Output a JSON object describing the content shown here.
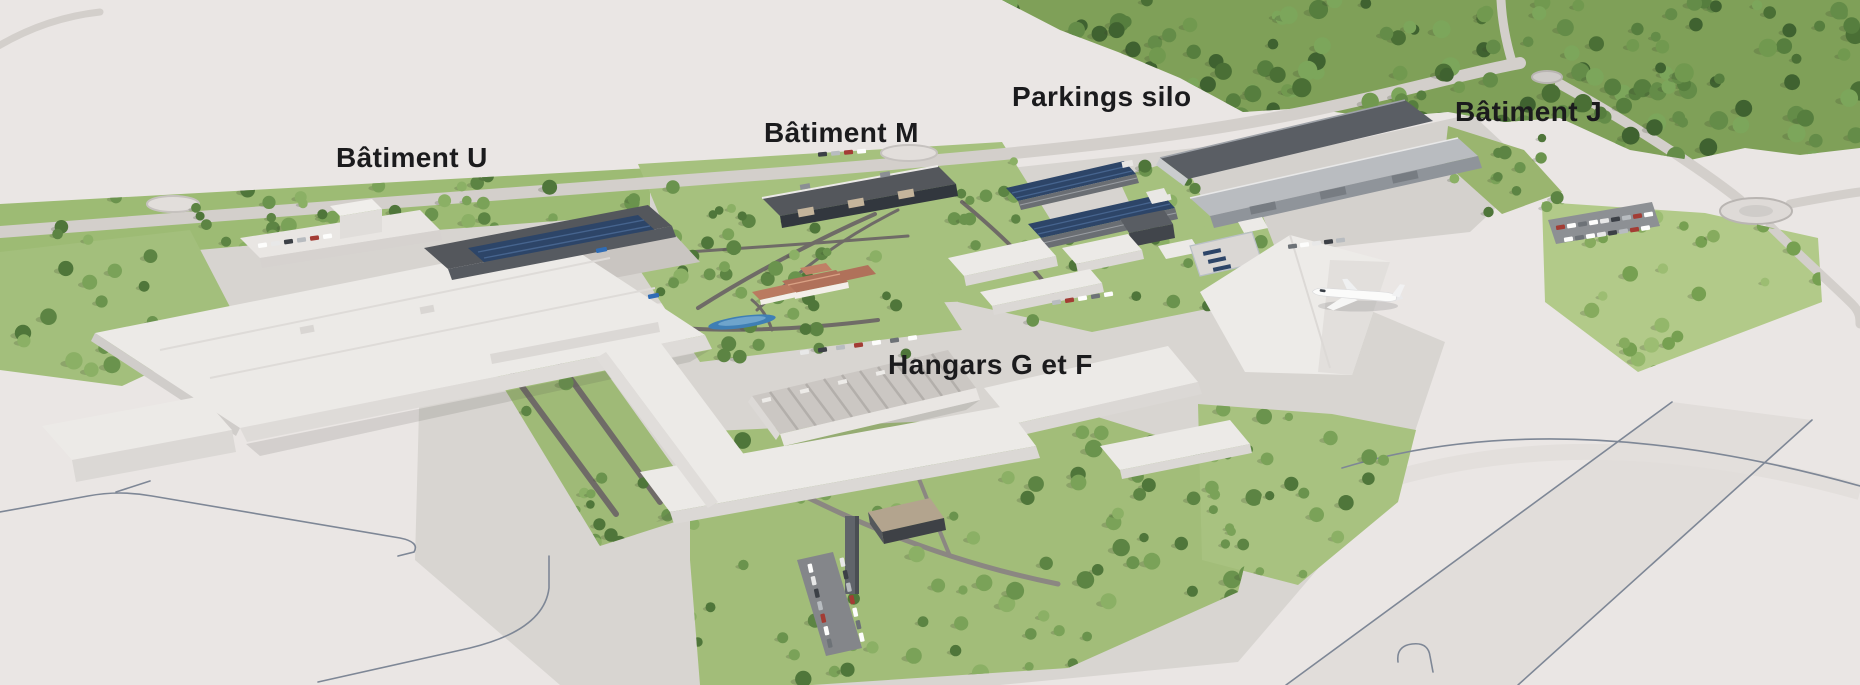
{
  "scene": {
    "labels": {
      "batiment_u": "Bâtiment U",
      "batiment_m": "Bâtiment M",
      "parkings_silo": "Parkings silo",
      "batiment_j": "Bâtiment J",
      "hangars_g_f": "Hangars G et F"
    },
    "colors": {
      "background": "#eae6e4",
      "apron": "#d8d5d1",
      "grass": "#a6c17e",
      "meadow": "#b2ca89",
      "forest_floor": "#7fa058",
      "building_white": "#eceae7",
      "building_wall": "#dbd8d5",
      "roof_dark": "#54575c",
      "solar_panel": "#2d4568",
      "roof_terracotta": "#b0715a",
      "water": "#3f7fb5",
      "label_text": "#1b1b1d"
    }
  }
}
